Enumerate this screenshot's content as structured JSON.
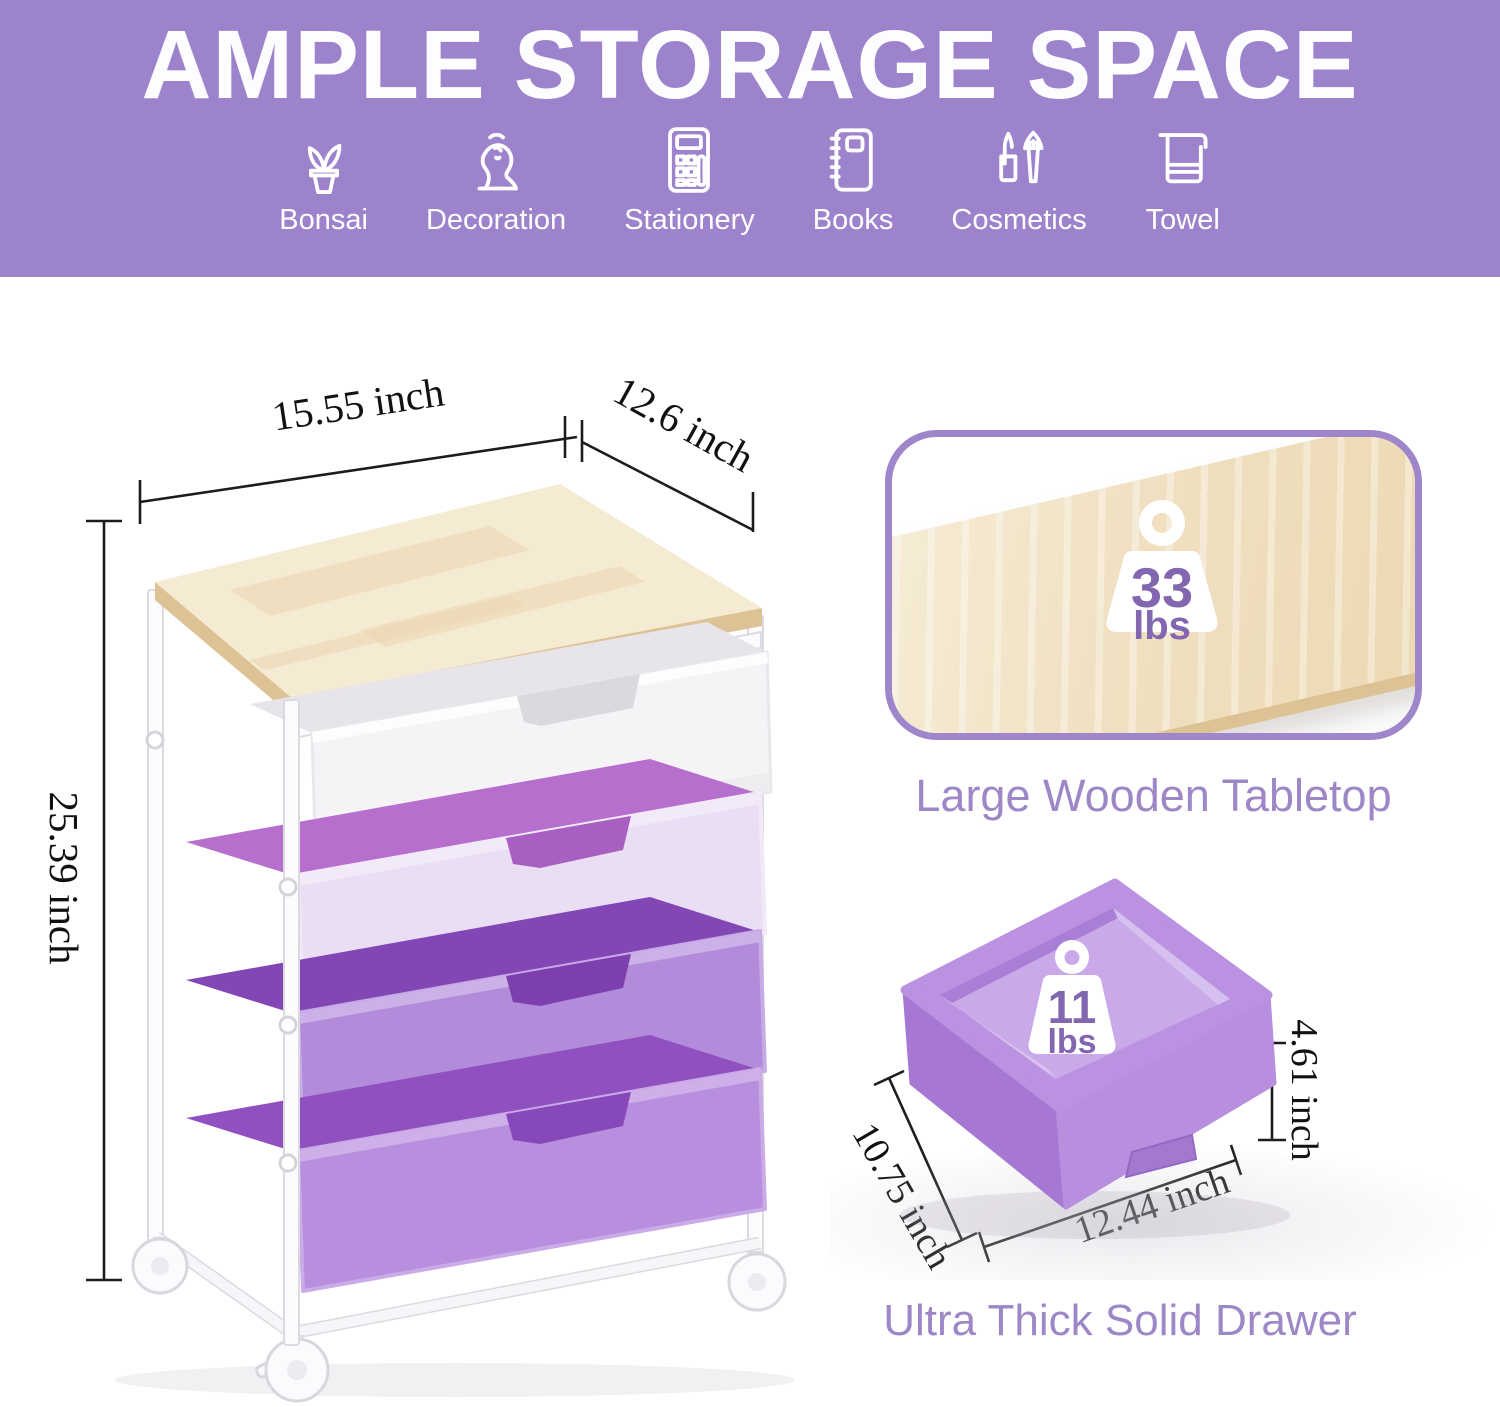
{
  "banner": {
    "title": "AMPLE STORAGE SPACE",
    "items": [
      {
        "label": "Bonsai",
        "icon": "bonsai-icon"
      },
      {
        "label": "Decoration",
        "icon": "bust-icon"
      },
      {
        "label": "Stationery",
        "icon": "calculator-icon"
      },
      {
        "label": "Books",
        "icon": "notebook-icon"
      },
      {
        "label": "Cosmetics",
        "icon": "lipstick-brush-icon"
      },
      {
        "label": "Towel",
        "icon": "towel-icon"
      }
    ]
  },
  "cart": {
    "width_label": "15.55 inch",
    "depth_label": "12.6 inch",
    "height_label": "25.39 inch"
  },
  "tabletop_callout": {
    "weight_value": "33",
    "weight_unit": "lbs",
    "caption": "Large Wooden Tabletop"
  },
  "drawer_callout": {
    "weight_value": "11",
    "weight_unit": "lbs",
    "caption": "Ultra Thick Solid Drawer",
    "depth_label": "10.75 inch",
    "width_label": "12.44 inch",
    "height_label": "4.61 inch"
  },
  "colors": {
    "banner_bg": "#9d83cc",
    "caption": "#9e87c7",
    "weight_number": "#8266b0",
    "callout_border": "#9f86ca",
    "dim_line": "#1c1c1c",
    "wood_light": "#f5ead2",
    "wood_mid": "#ead6b0",
    "wood_edge": "#dcc294",
    "frame_stroke": "#dcdae1",
    "drawer1_front": "#f5f3f6",
    "drawer1_inner": "#e7e4ea",
    "drawer2_front": "#eadef4",
    "drawer2_inner": "#b76fce",
    "drawer3_front": "#b28cda",
    "drawer3_inner": "#8347b5",
    "drawer4_front": "#b88ede",
    "drawer4_inner": "#9050c0",
    "photo_rim": "#bb92e1",
    "photo_wall_left": "#a678d3",
    "photo_wall_right": "#b88fdf",
    "photo_floor": "#c9a9e8"
  }
}
